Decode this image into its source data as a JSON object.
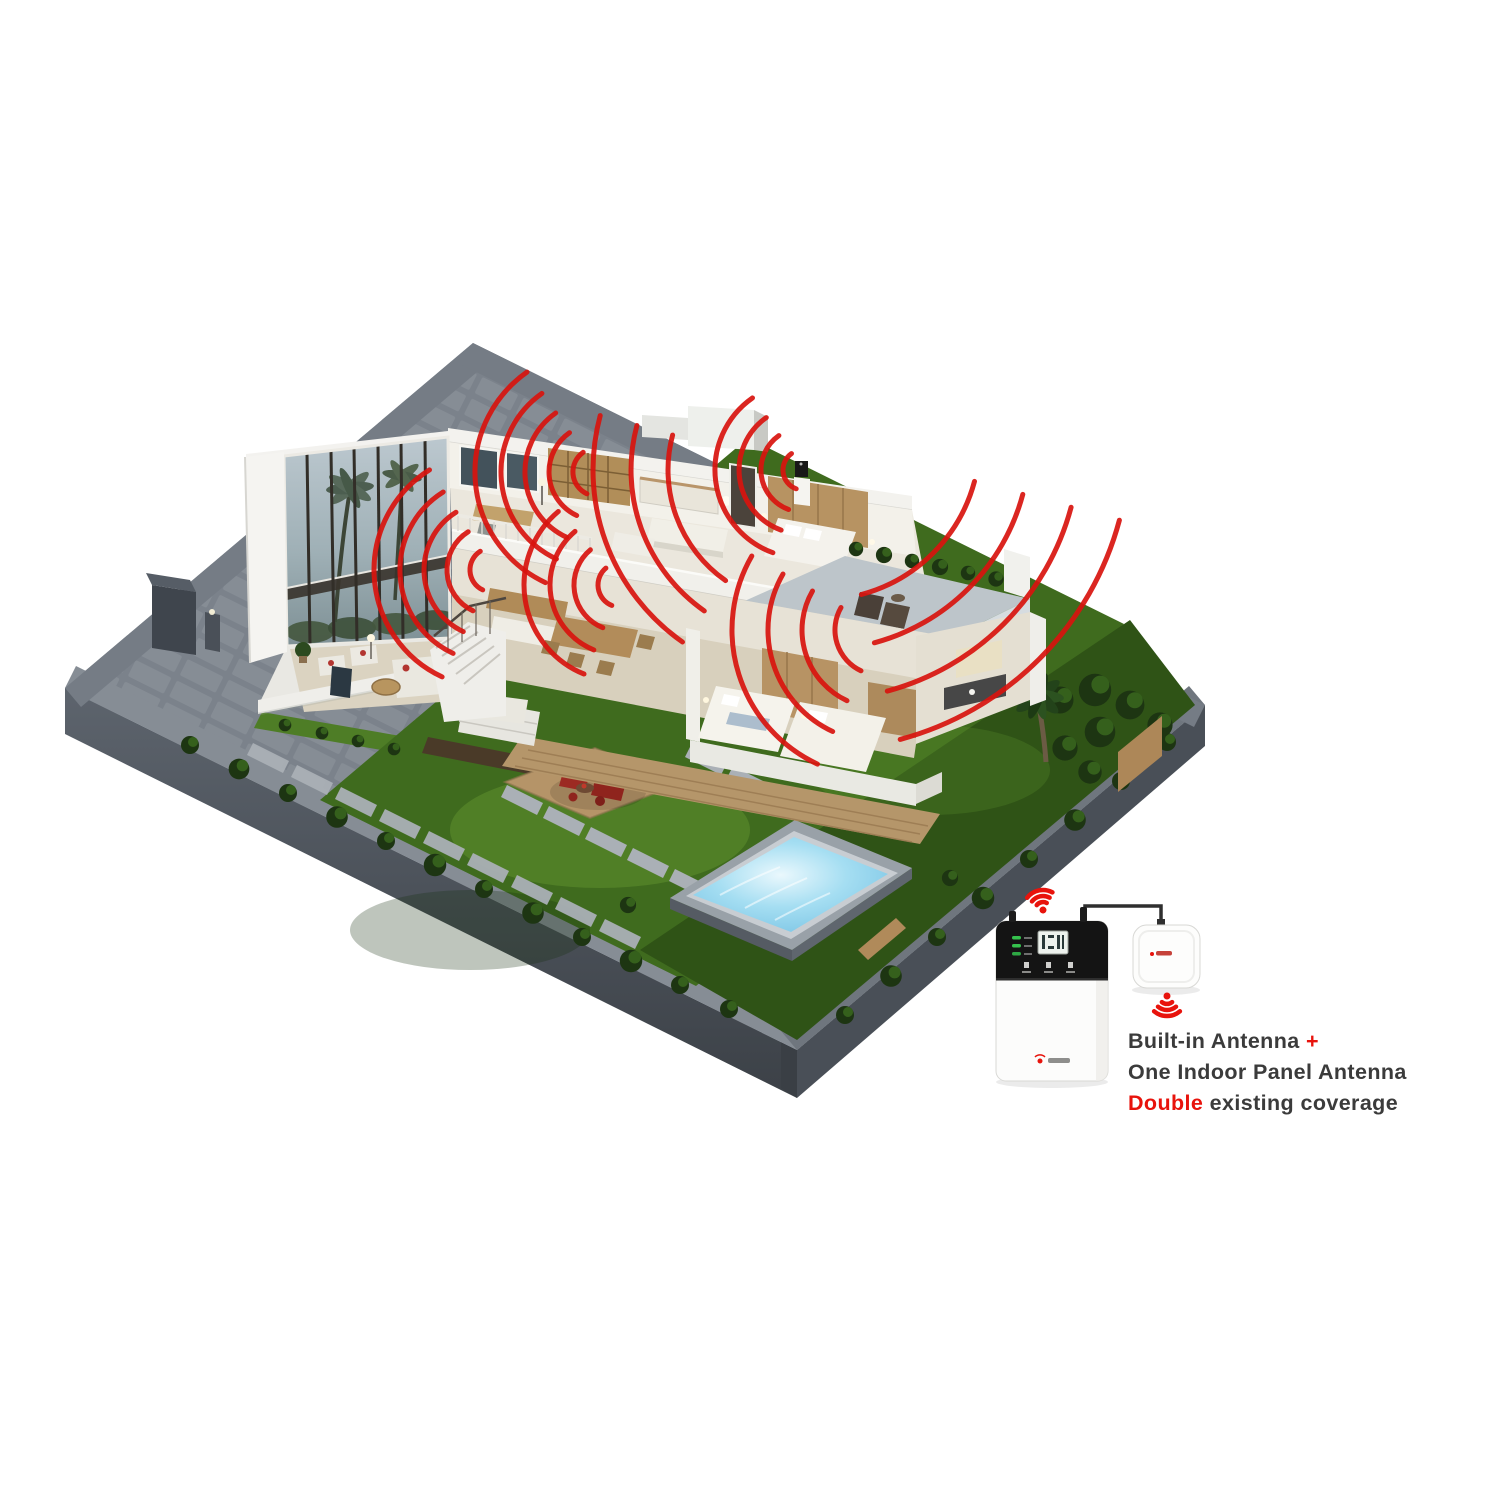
{
  "caption": {
    "line1_main": "Built-in Antenna",
    "line1_plus": "+",
    "line2": "One Indoor Panel Antenna",
    "line3_highlight": "Double",
    "line3_rest": " existing coverage"
  },
  "palette": {
    "signal_red": "#d8140e",
    "accent_red": "#e8130c",
    "text_dark": "#3b3b3b",
    "wall_gray": "#7b828b",
    "lawn_green": "#4e7d26",
    "pool_blue": "#8ed2ee"
  },
  "devices": {
    "booster_name": "signal-booster",
    "booster_led_count": 3,
    "panel_antenna_name": "indoor-panel-antenna"
  },
  "waves": {
    "color": "#d8140e",
    "stroke_width": 5,
    "sources": [
      {
        "id": "study",
        "cx": 597,
        "cy": 472,
        "radii": [
          24,
          48,
          72,
          96,
          122
        ],
        "a0": 115,
        "a1": 235
      },
      {
        "id": "master-bedroom",
        "cx": 803,
        "cy": 470,
        "radii": [
          20,
          42,
          64,
          88
        ],
        "a0": 110,
        "a1": 235
      },
      {
        "id": "master-floor-spill",
        "cx": 803,
        "cy": 470,
        "radii": [
          135,
          172,
          210
        ],
        "a0": 125,
        "a1": 195
      },
      {
        "id": "terrace-spill",
        "cx": 820,
        "cy": 440,
        "radii": [
          160,
          210,
          260,
          310
        ],
        "a0": 15,
        "a1": 75
      },
      {
        "id": "stairs",
        "cx": 492,
        "cy": 570,
        "radii": [
          22,
          45,
          68,
          92,
          118
        ],
        "a0": 115,
        "a1": 238
      },
      {
        "id": "dining",
        "cx": 620,
        "cy": 585,
        "radii": [
          22,
          46,
          70,
          96
        ],
        "a0": 112,
        "a1": 230
      },
      {
        "id": "bedroom-ground",
        "cx": 880,
        "cy": 630,
        "radii": [
          45,
          78,
          112,
          148
        ],
        "a0": 115,
        "a1": 210
      }
    ]
  },
  "wifi_icons": [
    {
      "id": "booster-wifi-icon",
      "cx": 1043,
      "cy": 910,
      "dir": "up",
      "tilt": -12
    },
    {
      "id": "antenna-wifi-icon",
      "cx": 1167,
      "cy": 996,
      "dir": "down",
      "tilt": 0
    }
  ]
}
